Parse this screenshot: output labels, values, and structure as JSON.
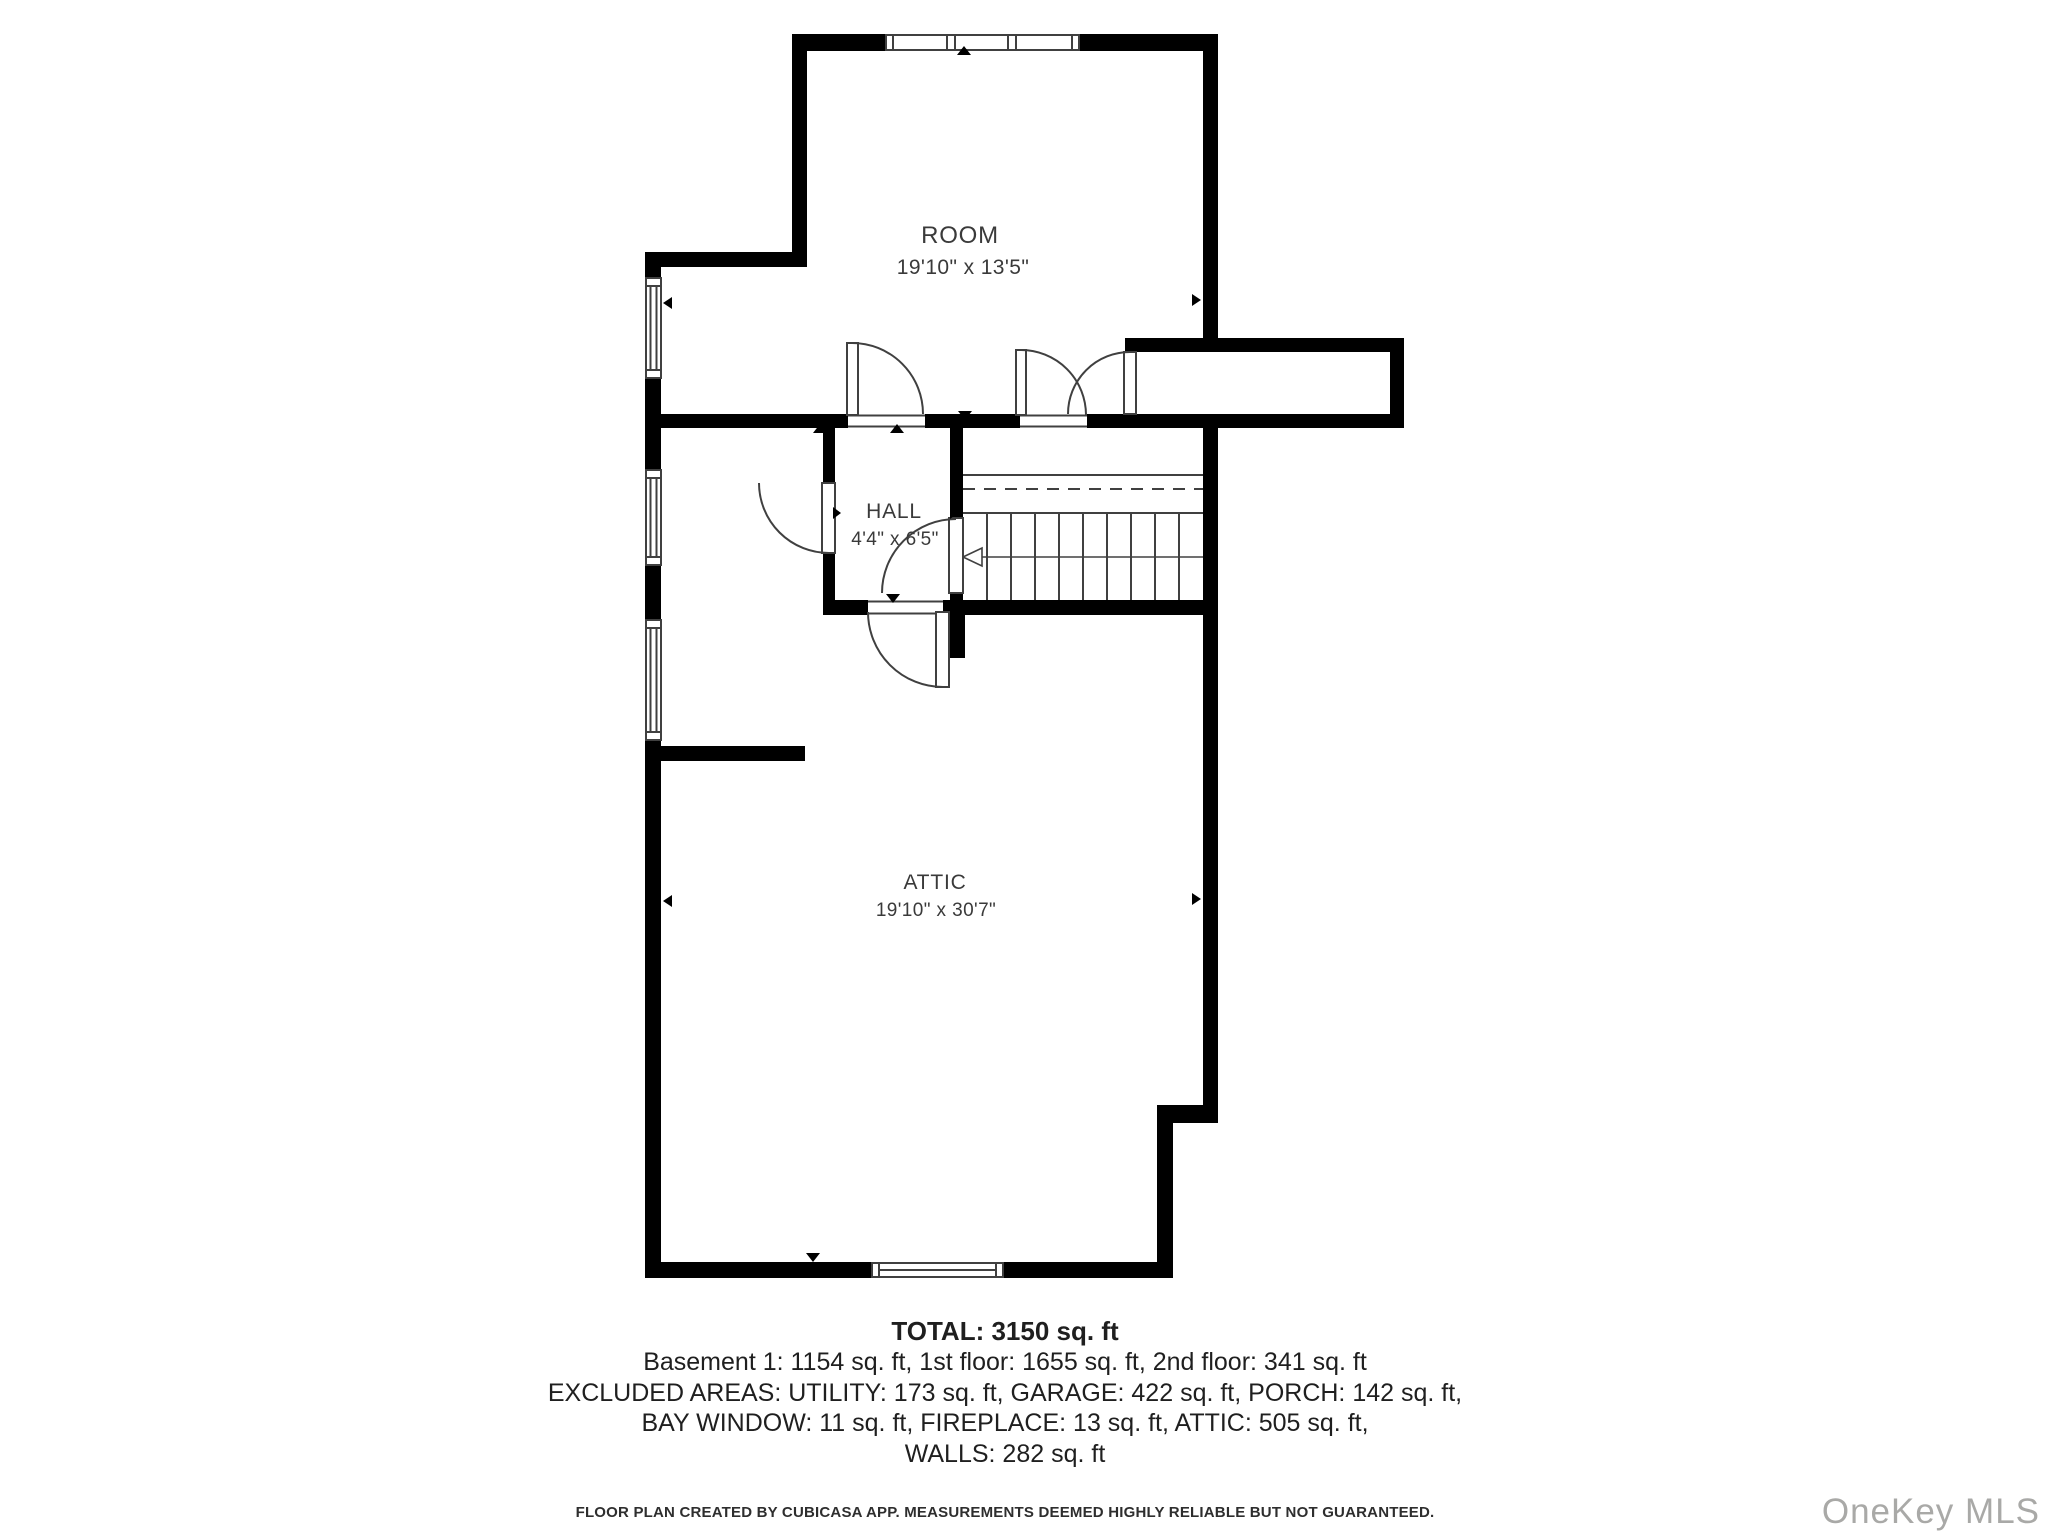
{
  "plan": {
    "rooms": [
      {
        "name": "ROOM",
        "dims": "19'10\" x 13'5\""
      },
      {
        "name": "HALL",
        "dims": "4'4\" x 6'5\""
      },
      {
        "name": "ATTIC",
        "dims": "19'10\" x 30'7\""
      }
    ],
    "summary": {
      "total": "TOTAL: 3150 sq. ft",
      "floors": "Basement 1: 1154 sq. ft, 1st floor: 1655 sq. ft, 2nd floor: 341 sq. ft",
      "excluded1": "EXCLUDED AREAS: UTILITY: 173 sq. ft, GARAGE: 422 sq. ft, PORCH: 142 sq. ft,",
      "excluded2": "BAY WINDOW: 11 sq. ft, FIREPLACE: 13 sq. ft, ATTIC: 505 sq. ft,",
      "excluded3": "WALLS: 282 sq. ft"
    },
    "disclaimer": "FLOOR PLAN CREATED BY CUBICASA APP. MEASUREMENTS DEEMED HIGHLY RELIABLE BUT NOT GUARANTEED.",
    "watermark": "OneKey MLS",
    "colors": {
      "wall": "#000000",
      "line": "#404040",
      "label": "#3a3a3a",
      "watermark": "#a9a9a7"
    }
  }
}
